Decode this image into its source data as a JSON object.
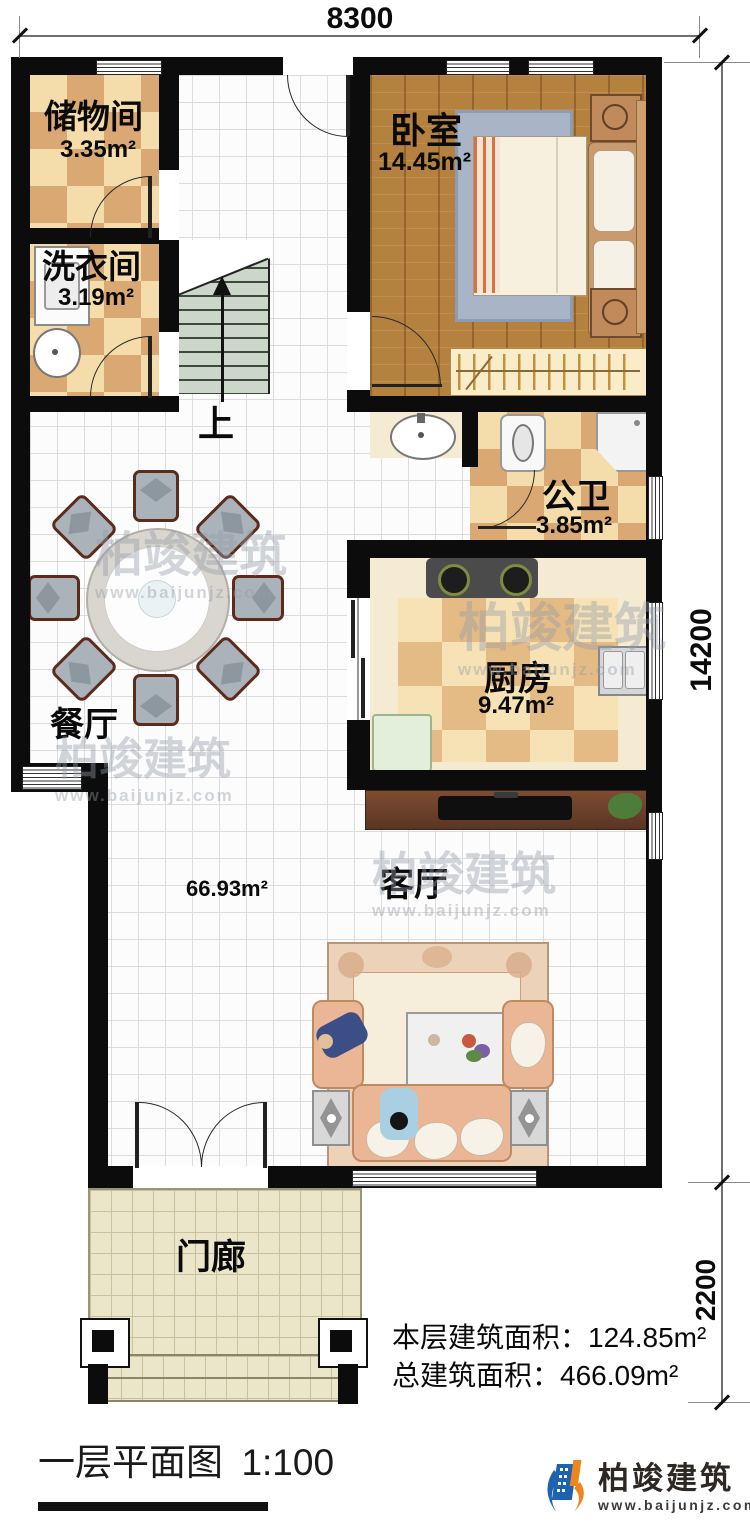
{
  "dims": {
    "top": "8300",
    "side": "14200",
    "porch": "2200"
  },
  "rooms": {
    "storage": {
      "name": "储物间",
      "area": "3.35m²"
    },
    "laundry": {
      "name": "洗衣间",
      "area": "3.19m²"
    },
    "bedroom": {
      "name": "卧室",
      "area": "14.45m²"
    },
    "bathroom": {
      "name": "公卫",
      "area": "3.85m²"
    },
    "kitchen": {
      "name": "厨房",
      "area": "9.47m²"
    },
    "dining": {
      "name": "餐厅"
    },
    "living": {
      "name": "客厅",
      "area": "66.93m²"
    },
    "porch": {
      "name": "门廊"
    },
    "stairs_up": "上"
  },
  "stats": {
    "floor_area": "本层建筑面积：124.85m²",
    "total_area": "总建筑面积：466.09m²"
  },
  "titleblock": {
    "title": "一层平面图",
    "scale": "1:100"
  },
  "logo": {
    "name": "柏竣建筑",
    "website": "www.baijunjz.com"
  },
  "watermark": {
    "name": "柏竣建筑",
    "website": "www.baijunjz.com"
  }
}
